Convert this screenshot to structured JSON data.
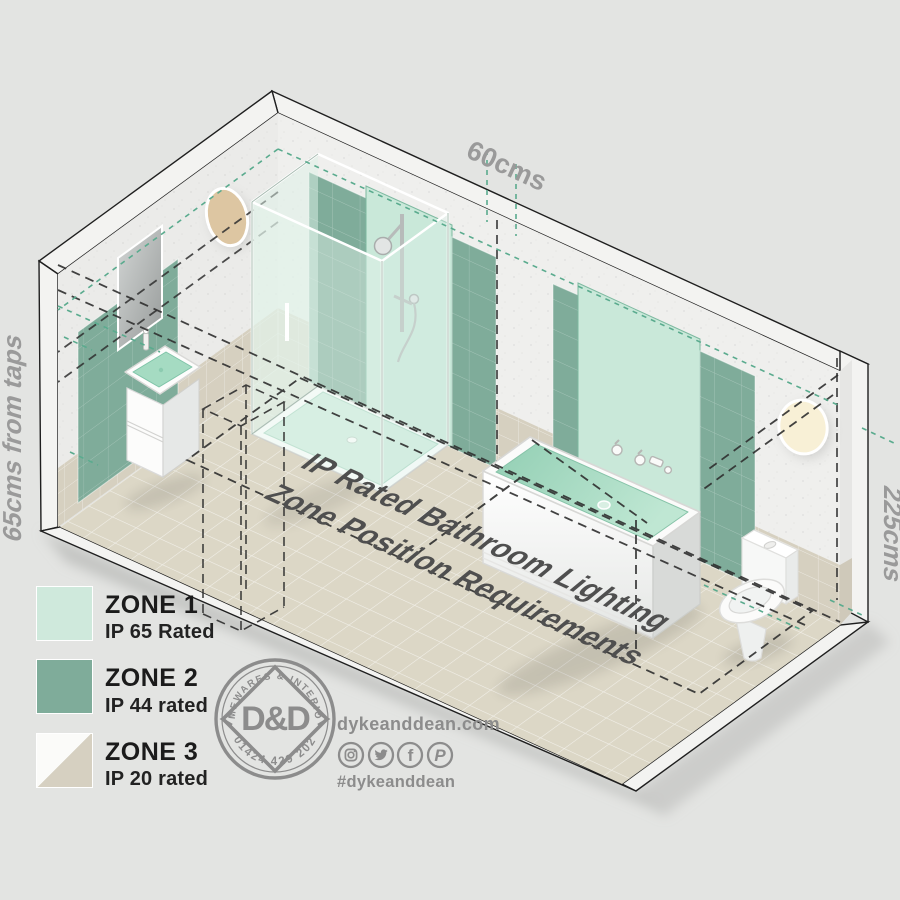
{
  "scene": {
    "dimension_labels": {
      "top": "60cms",
      "left": "65cms from taps",
      "right": "225cms"
    },
    "floor_title_line1": "IP Rated Bathroom Lighting",
    "floor_title_line2": "Zone Position Requirements",
    "fixtures": [
      "sink-vanity",
      "mirror",
      "shower-enclosure",
      "bathtub",
      "toilet",
      "wall-light-left",
      "wall-light-right"
    ]
  },
  "legend": {
    "items": [
      {
        "zone": "ZONE 1",
        "rating": "IP 65 Rated",
        "color": "#cfe9dc",
        "style": "solid"
      },
      {
        "zone": "ZONE 2",
        "rating": "IP 44 rated",
        "color": "#7fac9a",
        "style": "solid"
      },
      {
        "zone": "ZONE 3",
        "rating": "IP 20 rated",
        "color": "#d6d0c1",
        "color2": "#fbfbf9",
        "style": "diagonal"
      }
    ]
  },
  "brand": {
    "logo": {
      "arc_top": "HOMEWARES & INTERIORS",
      "monogram": "D&D",
      "phone": "01424 429 202"
    },
    "website": "dykeanddean.com",
    "hashtag": "#dykeanddean",
    "social_icons": [
      "instagram",
      "twitter",
      "facebook",
      "pinterest"
    ]
  },
  "colors": {
    "background": "#e3e4e2",
    "zone1_mint": "#cfe9dc",
    "zone2_green": "#7fac9a",
    "zone3_beige": "#d6d0c1",
    "floor_tile": "#dcd7c6",
    "wall_tile": "#d6d0c0",
    "concrete": "#eeeeec",
    "teal_dash": "#5aab8e",
    "dimension_gray": "#9a9a9a",
    "title_gray": "#4f4f4f",
    "brand_gray": "#8c8c8c"
  }
}
